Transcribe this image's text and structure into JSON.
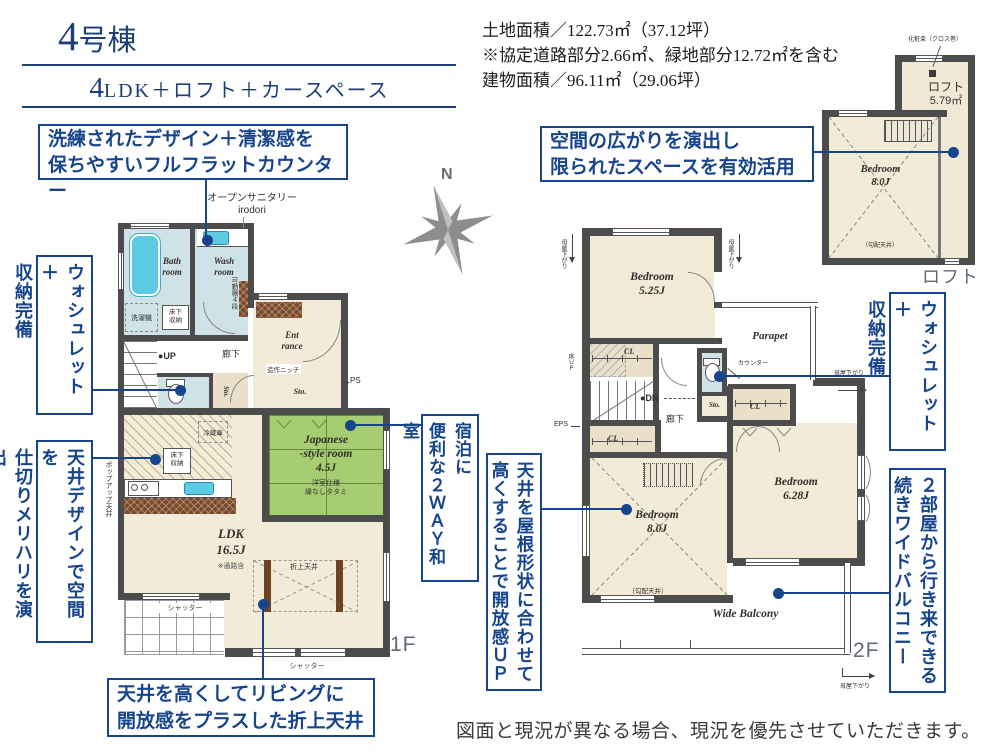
{
  "colors": {
    "accent": "#17458c",
    "wall": "#4c4c4c",
    "tatami": "#a6cd72",
    "fixture": "#5ecbe4",
    "header_navy": "#1c3f77"
  },
  "header": {
    "num": "4",
    "suffix": "号棟",
    "plan_num": "4",
    "plan_rest": "LDK＋ロフト＋カースペース"
  },
  "area_info": {
    "line1": "土地面積／122.73㎡（37.12坪）",
    "line2": "※協定道路部分2.66㎡、緑地部分12.72㎡を含む",
    "line3": "建物面積／96.11㎡（29.06坪）"
  },
  "compass": {
    "north": "N"
  },
  "callouts": {
    "counter": "洗練されたデザイン＋清潔感を\n保ちやすいフルフラットカウンター",
    "loft": "空間の広がりを演出し\n限られたスペースを有効活用",
    "washlet1f": "ウォシュレット＋\n収納完備",
    "ceiling_zone": "天井デザインで空間を\n仕切りメリハリを演出",
    "washitsu": "宿泊に\n便利な２ＷＡＹ和室",
    "sloped": "天井を屋根形状に合わせて\n高くすることで開放感ＵＰ",
    "coffered": "天井を高くしてリビングに\n開放感をプラスした折上天井",
    "washlet2f": "ウォシュレット＋\n収納完備",
    "balcony": "２部屋から行き来できる\n続きワイドバルコニー"
  },
  "plan1f": {
    "open_sanitary": "オープンサニタリー\nirodori",
    "bath": "Bath\nroom",
    "wash": "Wash\nroom",
    "washer": "洗濯機",
    "underfloor": "床下\n収納",
    "shelf": "可動棚４段",
    "entrance": "Ent\nrance",
    "niche": "造作ニッチ",
    "ps": "PS",
    "sto": "Sto.",
    "hallway": "廊下",
    "up": "●UP",
    "fridge": "冷蔵庫",
    "popup_ceiling": "ポップアップ天井",
    "japanese_room": "Japanese\n-style room\n4.5J",
    "japanese_note": "洋室仕様\n縁なしタタミ",
    "ldk": "LDK\n16.5J",
    "ldk_note": "※通路含",
    "coffered": "折上天井",
    "shutter": "シャッター"
  },
  "plan2f": {
    "bedroom_525": "Bedroom\n5.25J",
    "bedroom_80": "Bedroom\n8.0J",
    "bedroom_628": "Bedroom\n6.28J",
    "sloped_note": "（勾配天井）",
    "parapet": "Parapet",
    "cl": "CL",
    "floor_up": "床ＵＰ",
    "dn": "●DN",
    "hallway": "廊下",
    "counter": "カウンター",
    "sto": "Sto.",
    "eps": "EPS",
    "moya_sagari": "母屋下がり",
    "balcony": "Wide Balcony"
  },
  "loft": {
    "pillar": "化粧束（クロス巻）",
    "name": "ロフト",
    "size": "5.79㎡",
    "bedroom": "Bedroom\n8.0J",
    "sloped_note": "（勾配天井）"
  },
  "floor_labels": {
    "f1": "1F",
    "f2": "2F",
    "loft": "ロフト"
  },
  "footer": {
    "disclaimer": "図面と現況が異なる場合、現況を優先させていただきます。"
  }
}
